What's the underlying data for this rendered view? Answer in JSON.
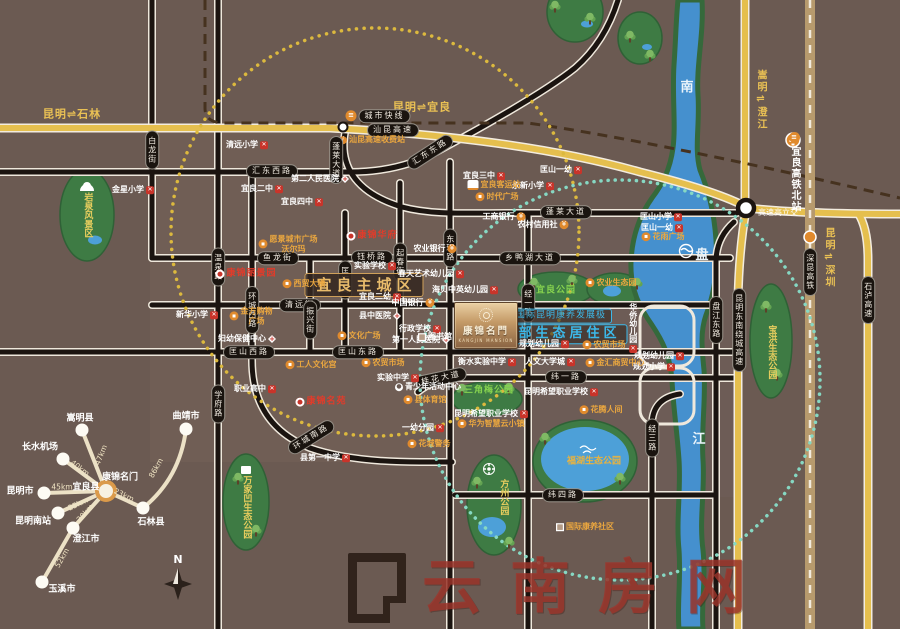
{
  "page": {
    "title": "康锦名门 区位图"
  },
  "colors": {
    "background": "#6b5a52",
    "highway_yellow": "#e5bf4e",
    "road_black": "#1b1410",
    "river_blue": "#4590ce",
    "park_green": "#3e7b44",
    "accent_blue": "#3cb9ea",
    "accent_gold": "#e8bb6b",
    "poi_orange": "#eba73f",
    "poi_red": "#e23b2a",
    "teal_ring": "#86d8c3",
    "yellow_ring": "#dcb93e",
    "watermark_red": "#9e352c"
  },
  "project": {
    "title": "康锦名門",
    "subtitle": "KANGJIN MANSION"
  },
  "watermark": {
    "text": "云南房网"
  },
  "compass": {
    "n": "N"
  },
  "spider": {
    "center": {
      "x": 106,
      "y": 491,
      "label": "康锦名门",
      "lx": 120,
      "ly": 478,
      "label2": "宜良县",
      "l2x": 86,
      "l2y": 488
    },
    "spokes": [
      {
        "city": "嵩明县",
        "km": "47km",
        "x": 82,
        "y": 430,
        "lx": 80,
        "ly": 419,
        "kx": 101,
        "ky": 455,
        "kr": -68
      },
      {
        "city": "长水机场",
        "km": "40km",
        "x": 63,
        "y": 459,
        "lx": 40,
        "ly": 448,
        "kx": 80,
        "ky": 468,
        "kr": 37
      },
      {
        "city": "昆明市",
        "km": "45km",
        "x": 44,
        "y": 493,
        "lx": 20,
        "ly": 492,
        "kx": 62,
        "ky": 487,
        "kr": 0
      },
      {
        "city": "昆明南站",
        "km": "25km",
        "x": 58,
        "y": 513,
        "lx": 33,
        "ly": 522,
        "kx": 78,
        "ky": 504,
        "kr": -25
      },
      {
        "city": "澄江市",
        "km": "30km",
        "x": 73,
        "y": 528,
        "lx": 86,
        "ly": 540,
        "kx": 85,
        "ky": 513,
        "kr": -48
      },
      {
        "city": "玉溪市",
        "km": "52km",
        "x": 42,
        "y": 582,
        "lx": 62,
        "ly": 590,
        "kx": 62,
        "ky": 558,
        "kr": -60,
        "from": [
          73,
          528
        ]
      },
      {
        "city": "石林县",
        "km": "23km",
        "x": 143,
        "y": 508,
        "lx": 151,
        "ly": 523,
        "kx": 124,
        "ky": 495,
        "kr": 25
      },
      {
        "city": "曲靖市",
        "km": "86km",
        "x": 186,
        "y": 429,
        "lx": 186,
        "ly": 417,
        "kx": 156,
        "ky": 468,
        "kr": -61,
        "from": [
          143,
          508
        ],
        "curve": [
          180,
          478
        ]
      }
    ]
  },
  "map": {
    "labels": [
      {
        "n": "dir-kunming-shilin",
        "t": "昆明⇌石林",
        "c": "yt",
        "x": 72,
        "y": 114
      },
      {
        "n": "dir-kunming-yiliang",
        "t": "昆明⇌宜良",
        "c": "yt",
        "x": 422,
        "y": 107
      },
      {
        "n": "dir-songming-chengjiang",
        "t": "嵩明⇌澄江",
        "c": "ytv",
        "x": 760,
        "y": 100
      },
      {
        "n": "dir-kunming-shenzhen",
        "t": "昆明⇌深圳",
        "c": "ytv",
        "x": 828,
        "y": 258
      },
      {
        "n": "road-shankun-expwy",
        "t": "汕昆高速",
        "c": "pill",
        "x": 393,
        "y": 130
      },
      {
        "n": "poi-city-express",
        "t": "城市快线",
        "c": "pill",
        "x": 378,
        "y": 116,
        "i": "t"
      },
      {
        "n": "poi-toll-station",
        "t": "汕昆高速收费站",
        "c": "o",
        "x": 372,
        "y": 140,
        "i": "i"
      },
      {
        "n": "road-huidong-west",
        "t": "汇东西路",
        "c": "pill",
        "x": 272,
        "y": 171
      },
      {
        "n": "road-huidong-east",
        "t": "汇东东路",
        "c": "pill",
        "x": 430,
        "y": 152,
        "r": -33
      },
      {
        "n": "road-penglai-v",
        "t": "蓬莱大道",
        "c": "pillv",
        "x": 336,
        "y": 160
      },
      {
        "n": "road-penglai-h",
        "t": "蓬莱大道",
        "c": "pill",
        "x": 566,
        "y": 212
      },
      {
        "n": "road-yulong",
        "t": "鱼龙街",
        "c": "pill",
        "x": 278,
        "y": 258
      },
      {
        "n": "road-yuqiao",
        "t": "钰桥路",
        "c": "pill",
        "x": 372,
        "y": 257
      },
      {
        "n": "road-xiangyahu",
        "t": "乡鸭湖大道",
        "c": "pill",
        "x": 530,
        "y": 258
      },
      {
        "n": "road-qingyuan",
        "t": "清远街",
        "c": "pill",
        "x": 300,
        "y": 305
      },
      {
        "n": "road-kuangshan-west",
        "t": "匡山西路",
        "c": "pill",
        "x": 249,
        "y": 352
      },
      {
        "n": "road-kuangshan-east",
        "t": "匡山东路",
        "c": "pill",
        "x": 358,
        "y": 352
      },
      {
        "n": "road-guihua",
        "t": "桂花大道",
        "c": "pill",
        "x": 441,
        "y": 378,
        "r": -12
      },
      {
        "n": "road-wei1",
        "t": "纬一路",
        "c": "pill",
        "x": 566,
        "y": 377
      },
      {
        "n": "road-wei4",
        "t": "纬四路",
        "c": "pill",
        "x": 563,
        "y": 495
      },
      {
        "n": "road-huancheng-south",
        "t": "环城南路",
        "c": "pill",
        "x": 311,
        "y": 437,
        "r": -32
      },
      {
        "n": "road-bailong",
        "t": "白龙街",
        "c": "pillv",
        "x": 152,
        "y": 150
      },
      {
        "n": "road-wenquan",
        "t": "温泉路",
        "c": "pillv",
        "x": 218,
        "y": 267
      },
      {
        "n": "road-xuefu",
        "t": "学府路",
        "c": "pillv",
        "x": 218,
        "y": 404
      },
      {
        "n": "road-huancheng-west",
        "t": "环城西路",
        "c": "pillv",
        "x": 252,
        "y": 310
      },
      {
        "n": "road-zhenxing",
        "t": "振兴街",
        "c": "pillv",
        "x": 310,
        "y": 320
      },
      {
        "n": "road-kuangyuan",
        "t": "匡远街",
        "c": "pillv",
        "x": 345,
        "y": 280
      },
      {
        "n": "road-qichun",
        "t": "起春街",
        "c": "pillv",
        "x": 400,
        "y": 262
      },
      {
        "n": "road-donghuan",
        "t": "东环路",
        "c": "pillv",
        "x": 450,
        "y": 248
      },
      {
        "n": "road-jing1",
        "t": "经一路",
        "c": "pillv",
        "x": 528,
        "y": 303
      },
      {
        "n": "road-jing3",
        "t": "经三路",
        "c": "pillv",
        "x": 652,
        "y": 438
      },
      {
        "n": "road-panjiang-east",
        "t": "盘江东路",
        "c": "pillv",
        "x": 716,
        "y": 320
      },
      {
        "n": "road-raocheng-expwy",
        "t": "昆明东南绕城高速",
        "c": "pillv",
        "x": 739,
        "y": 330
      },
      {
        "n": "road-shilu-expwy",
        "t": "石泸高速",
        "c": "pillv",
        "x": 868,
        "y": 300
      },
      {
        "n": "rail-shenkun-hsr",
        "t": "深昆高铁",
        "c": "pillv",
        "x": 810,
        "y": 272
      },
      {
        "n": "poi-hsr-north-station",
        "t": "宜良高铁北站",
        "c": "wtv",
        "x": 794,
        "y": 172,
        "i": "t"
      },
      {
        "n": "poi-interchange",
        "t": "高速高立交",
        "c": "wt",
        "x": 778,
        "y": 213
      },
      {
        "n": "river-nan",
        "t": "南",
        "c": "riv",
        "x": 687,
        "y": 88
      },
      {
        "n": "river-pan",
        "t": "盘",
        "c": "riv",
        "x": 702,
        "y": 256
      },
      {
        "n": "river-jiang",
        "t": "江",
        "c": "riv",
        "x": 699,
        "y": 440
      },
      {
        "n": "zone-yiliang-core",
        "t": "宜良主城区",
        "c": "zone",
        "x": 364,
        "y": 285
      },
      {
        "n": "zone-kangyang",
        "t": "国际昆明康养发展极",
        "c": "blue1",
        "x": 561,
        "y": 316
      },
      {
        "n": "zone-eastern-eco",
        "t": "东部生态居住区",
        "c": "blue2",
        "x": 561,
        "y": 334
      },
      {
        "t": "清远小学",
        "c": "w",
        "x": 247,
        "y": 145,
        "i": "x"
      },
      {
        "t": "金星小学",
        "c": "w",
        "x": 133,
        "y": 190,
        "i": "x"
      },
      {
        "t": "宜良二中",
        "c": "w",
        "x": 262,
        "y": 189,
        "i": "x"
      },
      {
        "t": "宜良四中",
        "c": "w",
        "x": 302,
        "y": 202,
        "i": "x"
      },
      {
        "t": "第二人民医院",
        "c": "w",
        "x": 320,
        "y": 179,
        "i": "h"
      },
      {
        "t": "宜良三中",
        "c": "w",
        "x": 484,
        "y": 176,
        "i": "x"
      },
      {
        "t": "永新小学",
        "c": "w",
        "x": 533,
        "y": 186,
        "i": "x"
      },
      {
        "t": "匡山一幼",
        "c": "w",
        "x": 561,
        "y": 170,
        "i": "x"
      },
      {
        "t": "实验学校",
        "c": "w",
        "x": 375,
        "y": 266,
        "i": "x"
      },
      {
        "t": "宜良二幼",
        "c": "w",
        "x": 380,
        "y": 297,
        "i": "x"
      },
      {
        "t": "新华小学",
        "c": "w",
        "x": 197,
        "y": 315,
        "i": "x"
      },
      {
        "t": "县中医院",
        "c": "w",
        "x": 380,
        "y": 316,
        "i": "h"
      },
      {
        "t": "中国银行",
        "c": "w",
        "x": 413,
        "y": 303,
        "i": "y"
      },
      {
        "t": "行政学校",
        "c": "w",
        "x": 420,
        "y": 329,
        "i": "x"
      },
      {
        "t": "第一人民医院",
        "c": "w",
        "x": 421,
        "y": 340,
        "i": "h"
      },
      {
        "t": "妇幼保健中心",
        "c": "w",
        "x": 247,
        "y": 339,
        "i": "h"
      },
      {
        "t": "图书馆",
        "c": "w",
        "x": 435,
        "y": 337,
        "i": "bl"
      },
      {
        "t": "实验中学",
        "c": "w",
        "x": 398,
        "y": 378,
        "i": "x"
      },
      {
        "t": "青少年活动中心",
        "c": "w",
        "x": 428,
        "y": 387,
        "i": "p"
      },
      {
        "t": "一幼分园",
        "c": "w",
        "x": 423,
        "y": 428,
        "i": "x"
      },
      {
        "t": "县第一中学",
        "c": "w",
        "x": 325,
        "y": 458,
        "i": "x"
      },
      {
        "t": "职业高中",
        "c": "w",
        "x": 255,
        "y": 389,
        "i": "x"
      },
      {
        "t": "海贝中英幼儿园",
        "c": "w",
        "x": 465,
        "y": 290,
        "i": "x"
      },
      {
        "t": "春天艺术幼儿园",
        "c": "w",
        "x": 431,
        "y": 274,
        "i": "x"
      },
      {
        "t": "衡水实验中学",
        "c": "w",
        "x": 487,
        "y": 362,
        "i": "x"
      },
      {
        "t": "人文大学城",
        "c": "w",
        "x": 550,
        "y": 362,
        "i": "x"
      },
      {
        "t": "规划幼儿园",
        "c": "w",
        "x": 487,
        "y": 345,
        "i": "x"
      },
      {
        "t": "规划幼儿园",
        "c": "w",
        "x": 544,
        "y": 344,
        "i": "x"
      },
      {
        "t": "规划幼儿园",
        "c": "w",
        "x": 659,
        "y": 356,
        "i": "x"
      },
      {
        "t": "规划小学",
        "c": "w",
        "x": 654,
        "y": 367,
        "i": "x"
      },
      {
        "t": "昆明希望职业学校",
        "c": "w",
        "x": 561,
        "y": 392,
        "i": "x"
      },
      {
        "t": "昆明希望职业学校",
        "c": "w",
        "x": 491,
        "y": 414,
        "i": "x"
      },
      {
        "t": "匡山小学",
        "c": "w",
        "x": 661,
        "y": 217,
        "i": "x"
      },
      {
        "t": "匡山一幼",
        "c": "w",
        "x": 662,
        "y": 228,
        "i": "x"
      },
      {
        "t": "工商银行",
        "c": "w",
        "x": 504,
        "y": 217,
        "i": "y"
      },
      {
        "t": "农村信用社",
        "c": "w",
        "x": 543,
        "y": 225,
        "i": "y"
      },
      {
        "t": "农业银行",
        "c": "w",
        "x": 435,
        "y": 249,
        "i": "y"
      },
      {
        "t": "华侨幼儿园",
        "c": "wv",
        "x": 633,
        "y": 328,
        "i": "x"
      },
      {
        "t": "宜良客运站",
        "c": "o",
        "x": 494,
        "y": 185,
        "i": "b"
      },
      {
        "t": "时代广场",
        "c": "o",
        "x": 497,
        "y": 197,
        "i": "c"
      },
      {
        "t": "愿景城市广场\n沃尔玛",
        "c": "o",
        "x": 288,
        "y": 244,
        "i": "c"
      },
      {
        "t": "西贸大楼",
        "c": "o",
        "x": 304,
        "y": 284,
        "i": "c"
      },
      {
        "t": "金方购物\n广场",
        "c": "o",
        "x": 251,
        "y": 316,
        "i": "c"
      },
      {
        "t": "文化广场",
        "c": "o",
        "x": 359,
        "y": 336,
        "i": "c"
      },
      {
        "t": "工人文化宫",
        "c": "o",
        "x": 311,
        "y": 365,
        "i": "c"
      },
      {
        "t": "农贸市场",
        "c": "o",
        "x": 383,
        "y": 363,
        "i": "c"
      },
      {
        "t": "农贸市场",
        "c": "o",
        "x": 604,
        "y": 345,
        "i": "c"
      },
      {
        "t": "县体育馆",
        "c": "o",
        "x": 425,
        "y": 400,
        "i": "c"
      },
      {
        "t": "花城警务",
        "c": "o",
        "x": 429,
        "y": 444,
        "i": "c"
      },
      {
        "t": "华为智慧云小镇",
        "c": "o",
        "x": 491,
        "y": 424,
        "i": "c"
      },
      {
        "t": "金汇商贸中心",
        "c": "o",
        "x": 615,
        "y": 363,
        "i": "c"
      },
      {
        "t": "花雨广场",
        "c": "o",
        "x": 663,
        "y": 237,
        "i": "c"
      },
      {
        "t": "花腾人间",
        "c": "o",
        "x": 601,
        "y": 410,
        "i": "c"
      },
      {
        "t": "国际康养社区",
        "c": "o",
        "x": 585,
        "y": 527,
        "i": "bl"
      },
      {
        "t": "农业生态园",
        "c": "o",
        "x": 611,
        "y": 283,
        "i": "c"
      },
      {
        "t": "宜良公园",
        "c": "pk",
        "x": 556,
        "y": 291
      },
      {
        "t": "三角梅公园",
        "c": "pk",
        "x": 489,
        "y": 391
      },
      {
        "t": "福湖生态公园",
        "c": "pko",
        "x": 594,
        "y": 462
      },
      {
        "t": "方州公园",
        "c": "pkv",
        "x": 503,
        "y": 497
      },
      {
        "t": "万家凹生态公园",
        "c": "pkv",
        "x": 246,
        "y": 507
      },
      {
        "t": "宝洪生态公园",
        "c": "pkv",
        "x": 771,
        "y": 352
      },
      {
        "t": "岩泉风景区",
        "c": "pkv",
        "x": 87,
        "y": 215
      },
      {
        "n": "poi-project-site",
        "t": "康锦华府",
        "c": "red",
        "x": 372,
        "y": 236,
        "i": "tg"
      },
      {
        "n": "poi-project-site",
        "t": "康锦丽景园",
        "c": "red",
        "x": 246,
        "y": 274,
        "i": "tg"
      },
      {
        "n": "poi-project-site",
        "t": "康锦名苑",
        "c": "red",
        "x": 321,
        "y": 402,
        "i": "tg"
      }
    ]
  }
}
